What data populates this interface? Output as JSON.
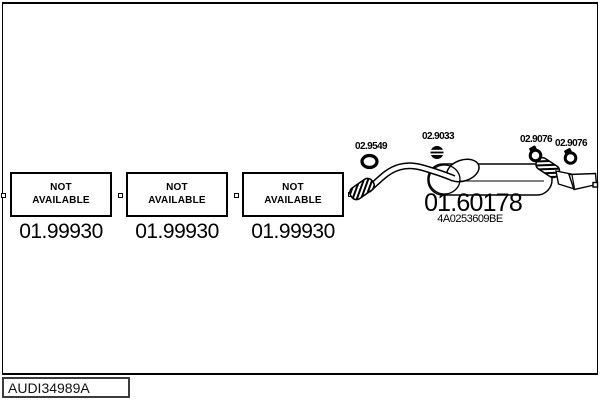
{
  "diagram": {
    "unavailable_parts": [
      {
        "status_line1": "NOT",
        "status_line2": "AVAILABLE",
        "part_number": "01.99930"
      },
      {
        "status_line1": "NOT",
        "status_line2": "AVAILABLE",
        "part_number": "01.99930"
      },
      {
        "status_line1": "NOT",
        "status_line2": "AVAILABLE",
        "part_number": "01.99930"
      }
    ],
    "muffler": {
      "part_number": "01.60178",
      "oem_reference": "4A0253609BE"
    },
    "fittings": [
      {
        "icon": "gasket-ring-icon",
        "part_number": "02.9549"
      },
      {
        "icon": "clamp-icon",
        "part_number": "02.9033"
      },
      {
        "icon": "clamp-icon",
        "part_number": "02.9076"
      },
      {
        "icon": "clamp-icon",
        "part_number": "02.9076"
      }
    ]
  },
  "footer": {
    "diagram_code": "AUDI34989A"
  },
  "colors": {
    "line": "#000000",
    "background": "#ffffff"
  }
}
